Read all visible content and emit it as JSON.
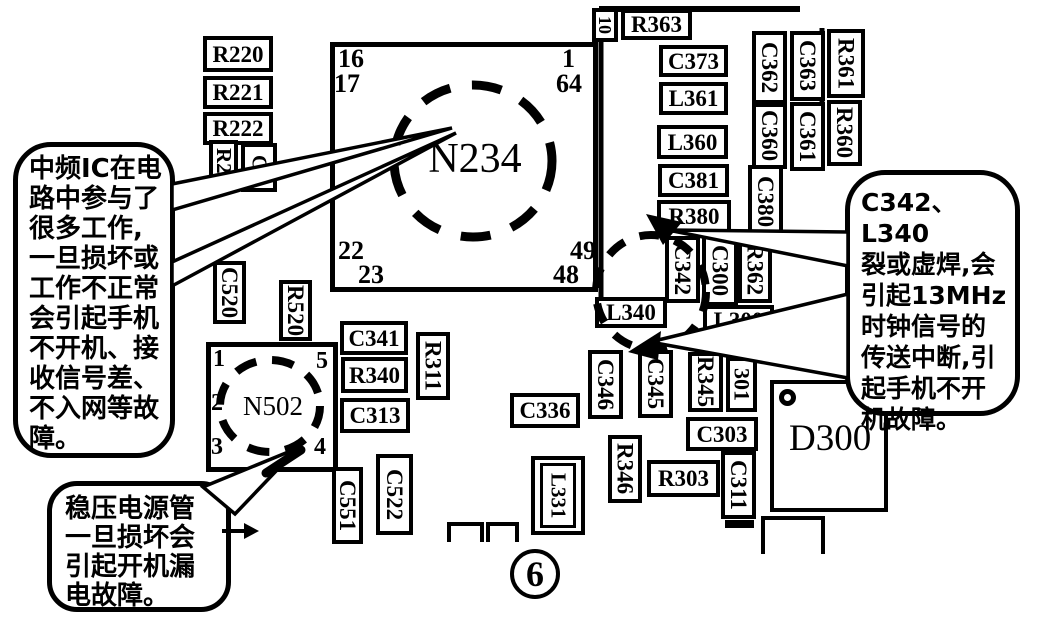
{
  "figure": {
    "number": "6"
  },
  "callouts": {
    "if_ic": {
      "text": "中频IC在电\n路中参与了\n很多工作,\n一旦损坏或\n工作不正常\n会引起手机\n不开机、接\n收信号差、\n不入网等故\n障。"
    },
    "clock": {
      "text": "C342、L340\n裂或虚焊,会\n引起13MHz\n时钟信号的\n传送中断,引\n起手机不开\n机故障。"
    },
    "regulator": {
      "text": "稳压电源管\n一旦损坏会\n引起开机漏\n电故障。"
    }
  },
  "ics": {
    "n234": {
      "label": "N234",
      "pins": {
        "p16": "16",
        "p17": "17",
        "p1": "1",
        "p64": "64",
        "p22": "22",
        "p23": "23",
        "p49": "49",
        "p48": "48"
      }
    },
    "n502": {
      "label": "N502",
      "pins": {
        "p1": "1",
        "p5": "5",
        "p2": "2",
        "p3": "3",
        "p4": "4"
      }
    },
    "d300": {
      "label": "D300"
    }
  },
  "components": {
    "r220": "R220",
    "r221": "R221",
    "r222": "R222",
    "r22_partial": "R22",
    "c3_partial": "C3",
    "n10": "10",
    "r363": "R363",
    "c373": "C373",
    "l361": "L361",
    "l360": "L360",
    "c381": "C381",
    "r380": "R380",
    "c362": "C362",
    "c363": "C363",
    "r361": "R361",
    "c360": "C360",
    "c361": "C361",
    "r360": "R360",
    "c380": "C380",
    "c342": "C342",
    "c300": "C300",
    "r362": "R362",
    "l300": "L300",
    "l340": "L340",
    "c520": "C520",
    "r520": "R520",
    "c341": "C341",
    "r340": "R340",
    "c313": "C313",
    "r311": "R311",
    "c522": "C522",
    "c551": "C551",
    "c336": "C336",
    "l331": "L331",
    "c346": "C346",
    "c345": "C345",
    "r345": "R345",
    "p301": "301",
    "r346": "R346",
    "r303": "R303",
    "c303": "C303",
    "c311": "C311"
  },
  "colors": {
    "ink": "#000000",
    "paper": "#ffffff"
  }
}
